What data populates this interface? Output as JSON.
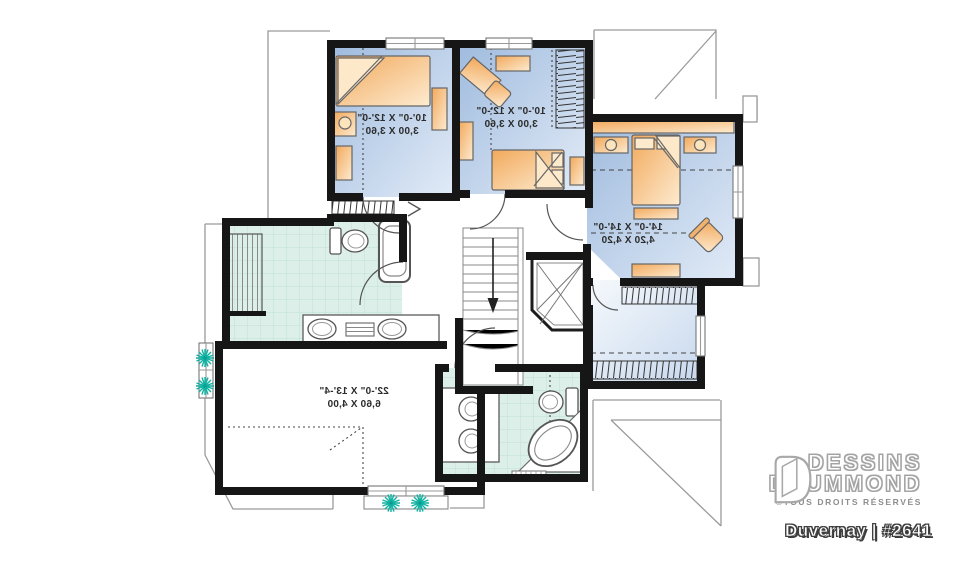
{
  "branding": {
    "name_line1": "DESSINS",
    "name_line2": "DRUMMOND",
    "rights": "©TOUS DROITS RÉSERVÉS",
    "plan_label": "Duvernay | #2641"
  },
  "rooms": [
    {
      "id": "bedroom-1",
      "dim_imperial": "10'-0\" X 12'-0\"",
      "dim_metric": "3,00 X 3,60"
    },
    {
      "id": "bedroom-2",
      "dim_imperial": "10'-0\" X 12'-0\"",
      "dim_metric": "3,00 X 3,60"
    },
    {
      "id": "master-bedroom",
      "dim_imperial": "14'-0\" X 14'-0\"",
      "dim_metric": "4,20 X 4,20"
    },
    {
      "id": "bonus-room",
      "dim_imperial": "22'-0\" X 13'-4\"",
      "dim_metric": "6,60 X 4,00"
    }
  ],
  "colors": {
    "wall": "#161616",
    "bedroom_floor": "#b7cbe7",
    "tile_floor": "#dcefe9",
    "furniture": "#f5c083",
    "plant_accent": "#10b2a2",
    "roof_line": "#9a9a9a"
  }
}
